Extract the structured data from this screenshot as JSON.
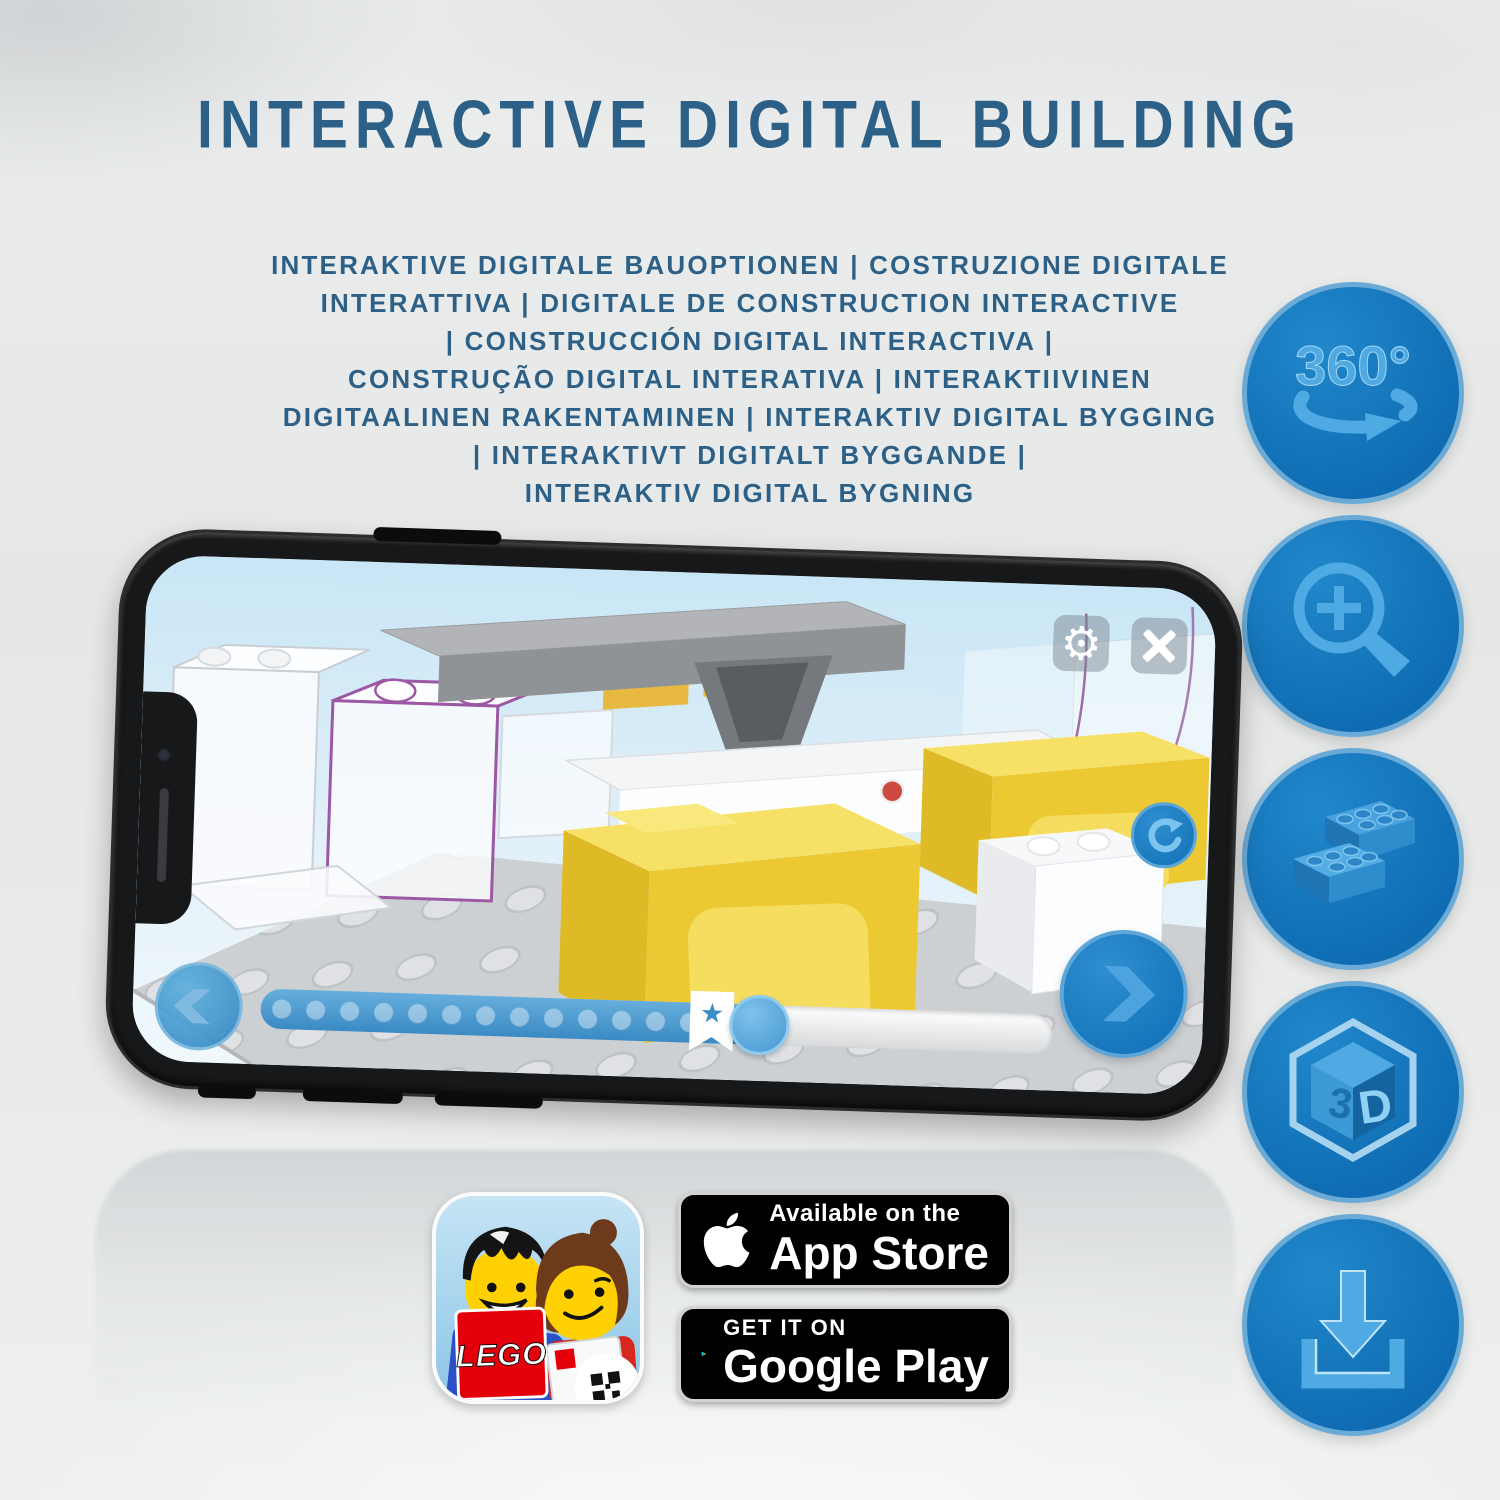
{
  "header": {
    "title": "INTERACTIVE DIGITAL BUILDING",
    "subtitle_lines": [
      "INTERAKTIVE DIGITALE BAUOPTIONEN | COSTRUZIONE DIGITALE",
      "INTERATTIVA | DIGITALE DE CONSTRUCTION INTERACTIVE",
      "| CONSTRUCCIÓN DIGITAL INTERACTIVA |",
      "CONSTRUÇÃO DIGITAL INTERATIVA | INTERAKTIIVINEN",
      "DIGITAALINEN RAKENTAMINEN | INTERAKTIV DIGITAL BYGGING",
      "| INTERAKTIVT DIGITALT BYGGANDE |",
      "INTERAKTIV DIGITAL BYGNING"
    ]
  },
  "feature_icons": [
    {
      "name": "rotate-360-icon",
      "label": "360°"
    },
    {
      "name": "zoom-in-icon"
    },
    {
      "name": "brick-icon"
    },
    {
      "name": "cube-3d-icon",
      "face_left": "3",
      "face_right": "D"
    },
    {
      "name": "download-icon"
    }
  ],
  "phone_app": {
    "settings_glyph": "⚙",
    "bookmark_glyph": "★",
    "progress_pct": 63,
    "bookmark_pct": 57,
    "icons": {
      "top_right": [
        "settings-gear",
        "close-x"
      ],
      "right": [
        "rotate-reset",
        "next-step-chevron"
      ],
      "bottom_left": "previous-step-chevron"
    }
  },
  "badges": {
    "app_store": {
      "tagline": "Available on the",
      "store": "App Store"
    },
    "google_play": {
      "tagline": "GET IT ON",
      "store": "Google Play"
    }
  },
  "app_icon": {
    "logo_text": "LEGO"
  },
  "colors": {
    "title_blue": "#2d6087",
    "circle_blue": "#0f6cb2",
    "glyph_blue": "#4fa9e2",
    "brick_yellow": "#ecc933",
    "lego_red": "#e3000b"
  }
}
